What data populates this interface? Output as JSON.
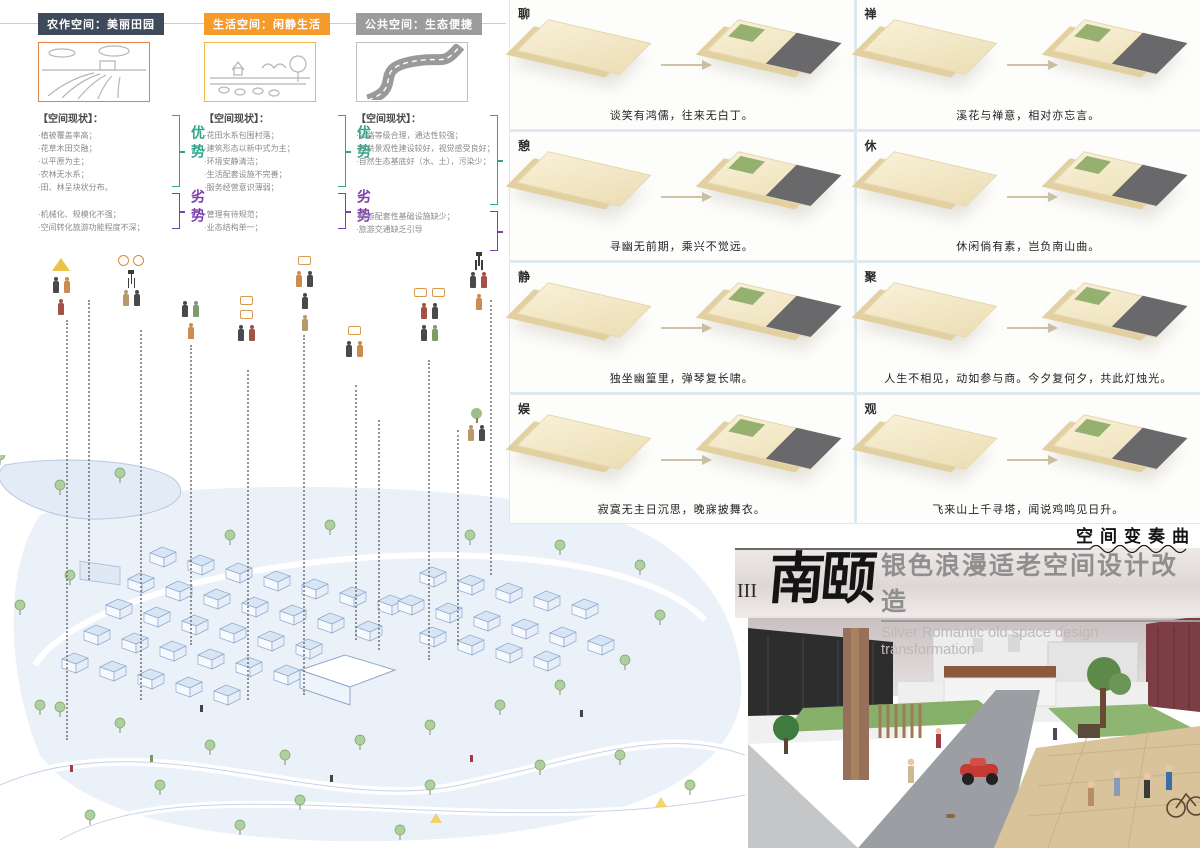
{
  "header": {
    "status_title": "【空间现状】：",
    "adv_label": "优势",
    "dis_label": "劣势",
    "columns": [
      {
        "badge": "农作空间：美丽田园",
        "badge_color": "#3f4a5a",
        "sketch": "farm-field-sketch",
        "sketch_border": "#e08244",
        "advantages": [
          "·植被覆盖率高；",
          "·花草木田交融；",
          "·以平原为主；",
          "·农林无水系；",
          "·田、林呈块状分布。"
        ],
        "disadvantages": [
          "·机械化、规模化不强；",
          "·空间转化旅游功能程度不深；"
        ]
      },
      {
        "badge": "生活空间：闲静生活",
        "badge_color": "#f59b2c",
        "sketch": "village-sketch",
        "sketch_border": "#f0b844",
        "advantages": [
          "·花田水系包围村落；",
          "·建筑形态以新中式为主；",
          "·环境安静清洁；",
          "·生活配套设施不完善；",
          "·服务经营意识薄弱；"
        ],
        "disadvantages": [
          "·管理有待规范；",
          "·业态结构单一；"
        ]
      },
      {
        "badge": "公共空间：生态便捷",
        "badge_color": "#9c9c9c",
        "sketch": "winding-road-sketch",
        "sketch_border": "#c2c2c2",
        "advantages": [
          "·公路等级合理，通达性较强；",
          "·公共景观性建设较好，视觉感受良好；",
          "·自然生态基底好（水、土），污染少；"
        ],
        "disadvantages": [
          "·旅游配套性基础设施缺少；",
          "·旅游交通缺乏引导"
        ]
      }
    ]
  },
  "activity_icons": [
    "tent",
    "bicycle",
    "camera-tripod",
    "photographer",
    "cheering-elder",
    "walking-elder",
    "elderly-couple",
    "picnic-food",
    "potted-tree",
    "musician"
  ],
  "transform_grid": {
    "cells": [
      {
        "label": "聊",
        "caption": "谈笑有鸿儒，往来无白丁。"
      },
      {
        "label": "禅",
        "caption": "溪花与禅意，相对亦忘言。"
      },
      {
        "label": "憩",
        "caption": "寻幽无前期，乘兴不觉远。"
      },
      {
        "label": "休",
        "caption": "休闲倘有素，岂负南山曲。"
      },
      {
        "label": "静",
        "caption": "独坐幽篁里，弹琴复长啸。"
      },
      {
        "label": "聚",
        "caption": "人生不相见，动如参与商。今夕复何夕，共此灯烛光。"
      },
      {
        "label": "娱",
        "caption": "寂寞无主日沉思，晚寐披舞衣。"
      },
      {
        "label": "观",
        "caption": "飞来山上千寻塔，闻说鸡鸣见日升。"
      }
    ]
  },
  "title_block": {
    "motto": "空间变奏曲",
    "numeral": "III",
    "logo": "南颐",
    "title_cn": "银色浪漫适老空间设计改造",
    "title_en": "Silver Romantic old space design transformation"
  },
  "colors": {
    "advantage": "#2fa58c",
    "disadvantage": "#7d3fae",
    "badge_farm": "#3f4a5a",
    "badge_life": "#f59b2c",
    "badge_public": "#9c9c9c",
    "map_blue": "#9fb8d8",
    "model_cream": "#f3e8c9"
  }
}
